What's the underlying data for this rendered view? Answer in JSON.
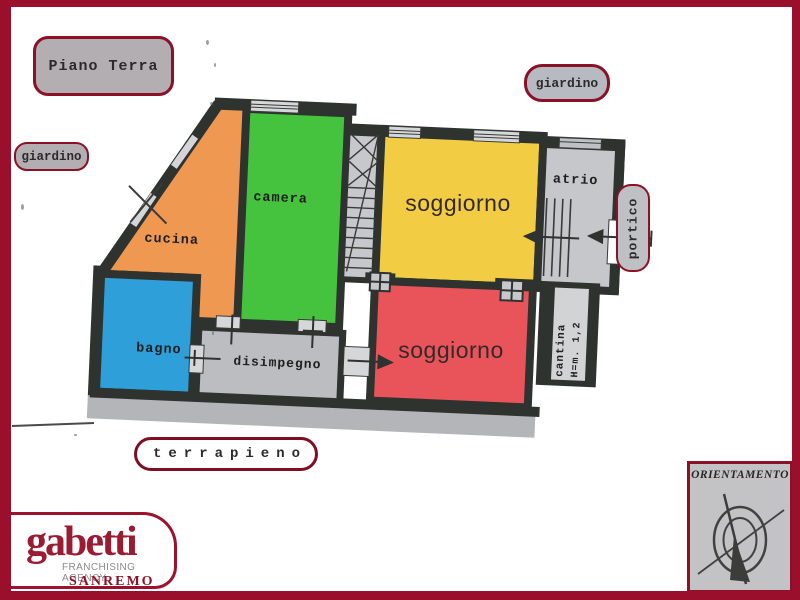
{
  "colors": {
    "page_frame": "#9a102c",
    "badge_border": "#8c1126",
    "badge_bg": "#b3aeb1",
    "wall": "#2e332f",
    "plan_light": "#c7c8cb",
    "window_light": "#d6d7d9",
    "ground_strip": "#b4b5b8",
    "camera": "#45c33e",
    "cucina": "#ee9851",
    "bagno": "#2e9fd8",
    "disimpegno": "#bcbdc0",
    "soggiorno_top": "#f2cd43",
    "soggiorno_bottom": "#e8545a",
    "atrio": "#c6c7ca",
    "cantina_strip": "#d2d3d5",
    "logo_red": "#9b1b32",
    "text_dark": "#1f1f1f",
    "soggiorno_label": "#33292a"
  },
  "badges": {
    "floor_label": "Piano Terra",
    "garden_left": "giardino",
    "garden_top": "giardino",
    "portico": "portico",
    "terrapieno": "terrapieno"
  },
  "rooms": {
    "camera": "camera",
    "cucina": "cucina",
    "bagno": "bagno",
    "disimpegno": "disimpegno",
    "soggiorno_top": "soggiorno",
    "soggiorno_bottom": "soggiorno",
    "atrio": "atrio",
    "cantina_name": "cantina",
    "cantina_height": "H=m. 1,2"
  },
  "orientation": {
    "title": "ORIENTAMENTO"
  },
  "logo": {
    "brand": "gabetti",
    "tagline": "FRANCHISING AGENCY",
    "city": "SANREMO"
  }
}
